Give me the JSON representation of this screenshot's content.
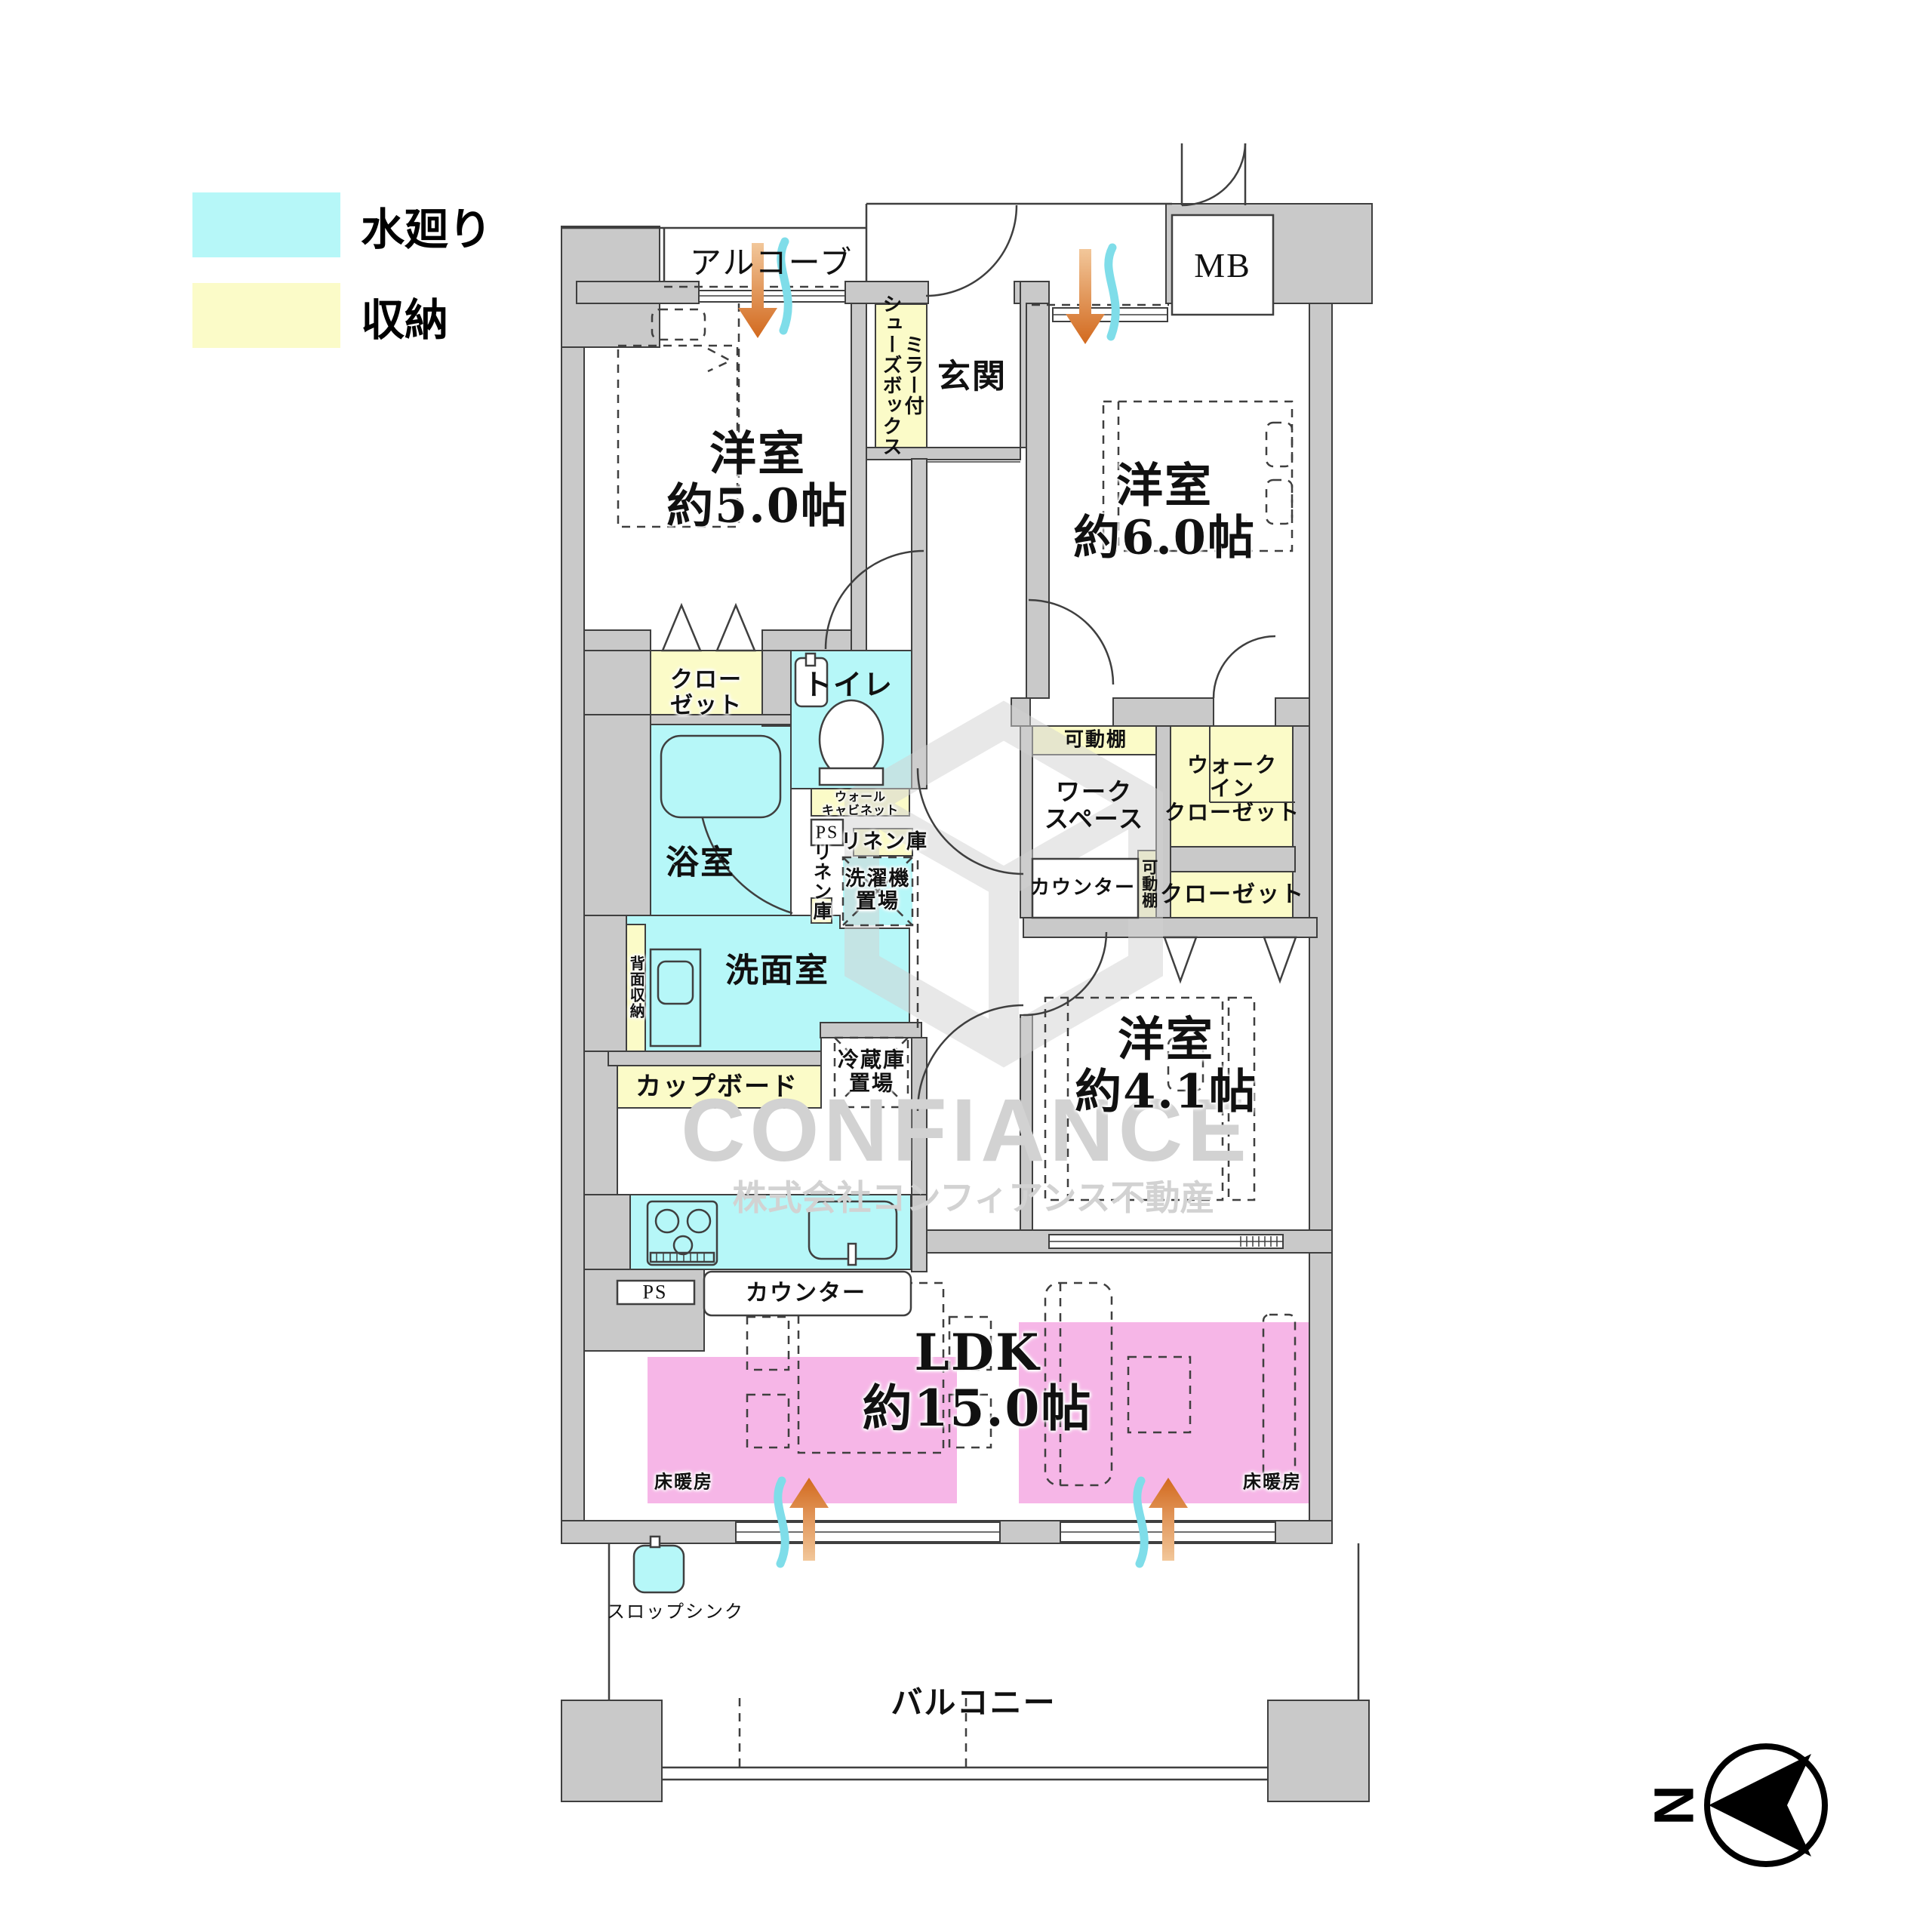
{
  "legend": {
    "items": [
      {
        "label": "水廻り",
        "color": "#b6f7f8"
      },
      {
        "label": "収納",
        "color": "#fbfbc8"
      }
    ]
  },
  "rooms": {
    "western5": {
      "line1": "洋室",
      "line2": "約5.0帖"
    },
    "western6": {
      "line1": "洋室",
      "line2": "約6.0帖"
    },
    "western41": {
      "line1": "洋室",
      "line2": "約4.1帖"
    },
    "ldk": {
      "line1": "LDK",
      "line2": "約15.0帖"
    },
    "genkan": "玄関",
    "alcove": "アルコーブ",
    "mb": "MB",
    "toilet": "トイレ",
    "bath": "浴室",
    "washroom": "洗面室",
    "balcony": "バルコニー",
    "workspace": [
      "ワーク",
      "スペース"
    ]
  },
  "storage": {
    "shoebox": [
      "ミラー付",
      "シューズボックス"
    ],
    "closet_a": [
      "クロー",
      "ゼット"
    ],
    "wall_cabinet": [
      "ウォール",
      "キャビネット"
    ],
    "linen_a": "リネン庫",
    "linen_b": "リネン庫",
    "back_storage": "背面収納",
    "cupboard": "カップボード",
    "shelf_top": "可動棚",
    "shelf_side": "可動棚",
    "wic": [
      "ウォーク",
      "イン",
      "クローゼット"
    ],
    "closet_b": "クローゼット"
  },
  "fixtures": {
    "washer": [
      "洗濯機",
      "置場"
    ],
    "fridge": [
      "冷蔵庫",
      "置場"
    ],
    "counter_kitchen": "カウンター",
    "counter_work": "カウンター",
    "ps_a": "PS",
    "ps_b": "PS",
    "slop_sink": "スロップシンク",
    "floor_heating_left": "床暖房",
    "floor_heating_right": "床暖房"
  },
  "watermark": {
    "brand": "CONFIANCE",
    "company": "株式会社コンフィアンス不動産"
  },
  "compass": {
    "north_label": "N"
  },
  "colors": {
    "water": "#b6f7f8",
    "storage": "#fbfbc8",
    "floor_heating": "#f6b6e7",
    "wall": "#c9c9c9",
    "arrow_orange": "#d2691e",
    "wave_cyan": "#7fdde9",
    "watermark_gray": "#d2d2d2"
  }
}
